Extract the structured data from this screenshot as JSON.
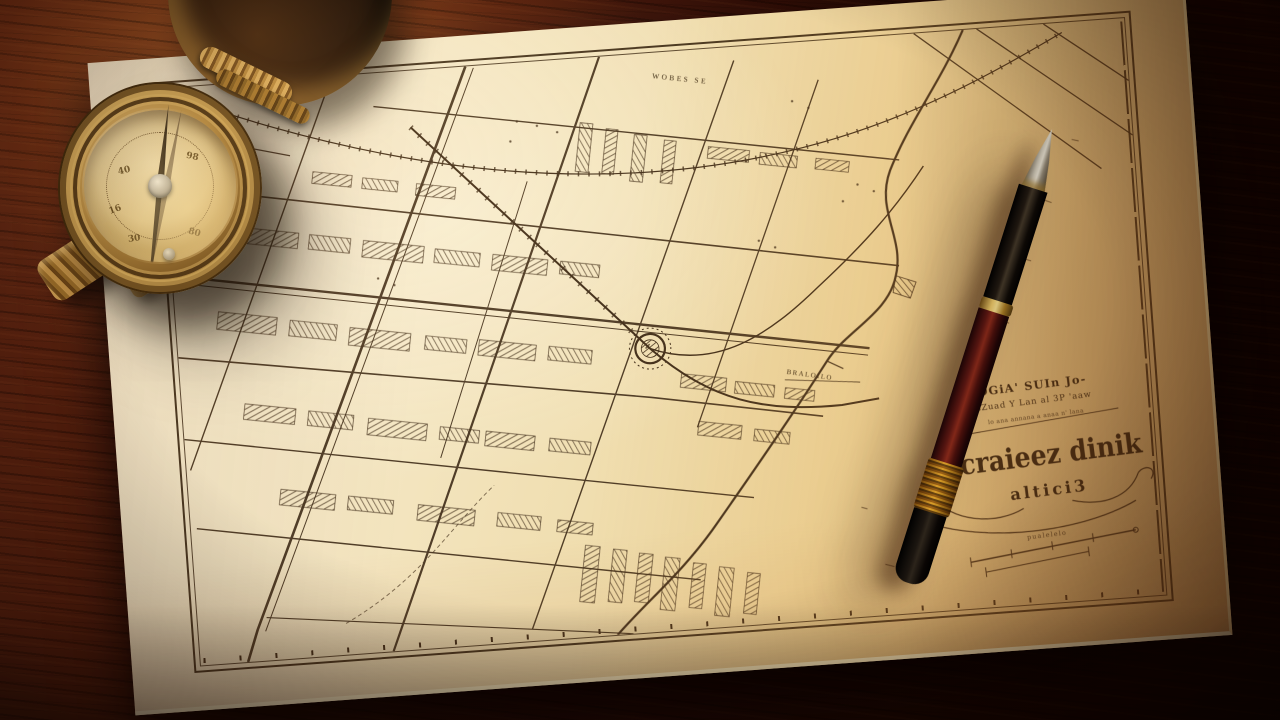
{
  "scene": {
    "objects": [
      "antique-city-map",
      "brass-compass",
      "fountain-pen",
      "wooden-desk"
    ]
  },
  "palette": {
    "wood_highlight": "#6b2d12",
    "wood_shadow": "#170402",
    "paper": "#f3e4bd",
    "paper_warm": "#e4bc82",
    "map_ink": "#43301c",
    "brass": "#c59347",
    "pen_barrel": "#5a1512",
    "pen_gold": "#d4a742",
    "pen_black": "#0d0a08",
    "needle": "#2a1c0e"
  },
  "map": {
    "street_label": "WOBES SE",
    "shore_label": "BRALOILO",
    "cartouche": {
      "line1": "OGiA' SUIn Jo-",
      "line2": "sZuad Y Lan al 3P 'aaw",
      "line3": "lo ana annana a anaa n' lana",
      "title": "Ccraieez dinik",
      "subtitle": "altici3",
      "scale_note": "pualelelo"
    }
  },
  "compass": {
    "dial_markings": [
      "40",
      "98",
      "16",
      "30",
      "80"
    ]
  }
}
